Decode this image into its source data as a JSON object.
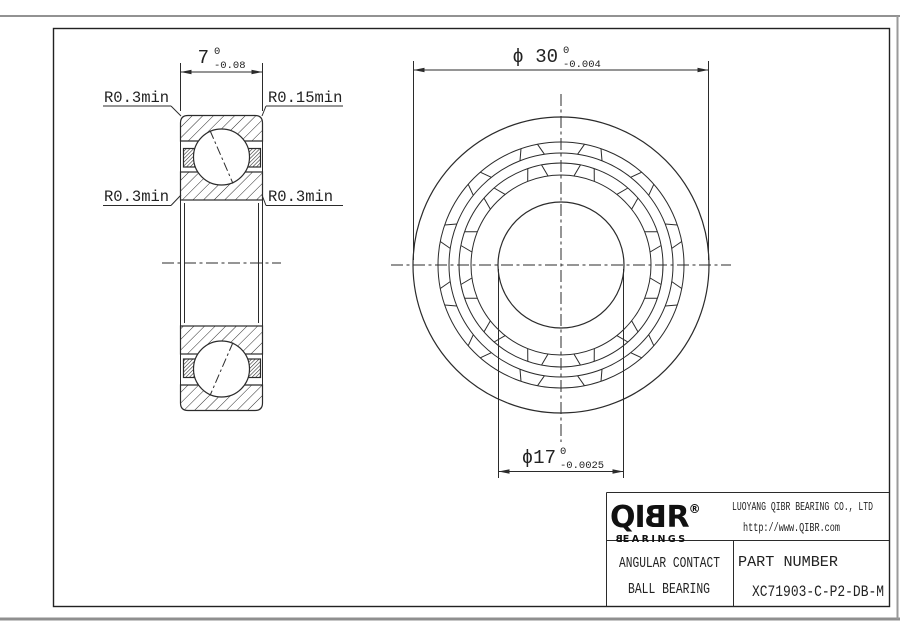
{
  "page": {
    "background": "#ffffff",
    "line_color": "#2b2b2b"
  },
  "dimensions": {
    "width": {
      "value": "7",
      "tol_upper": "0",
      "tol_lower": "-0.08"
    },
    "outer_diameter": {
      "value": "ϕ 30",
      "tol_upper": "0",
      "tol_lower": "-0.004"
    },
    "bore_diameter": {
      "value": "ϕ17",
      "tol_upper": "0",
      "tol_lower": "-0.0025"
    }
  },
  "radius_labels": {
    "top_left": "R0.3min",
    "top_right": "R0.15min",
    "mid_left": "R0.3min",
    "mid_right": "R0.3min"
  },
  "title_block": {
    "logo": {
      "part1": "QI",
      "part2": "B",
      "part3": "R",
      "registered": "®",
      "sub1": "B",
      "sub2": "EARINGS"
    },
    "company": "LUOYANG QIBR BEARING CO., LTD",
    "website": "http://www.QIBR.com",
    "product_line1": "ANGULAR CONTACT",
    "product_line2": "BALL BEARING",
    "part_number_label": "PART NUMBER",
    "part_number": "XC71903-C-P2-DB-M"
  }
}
